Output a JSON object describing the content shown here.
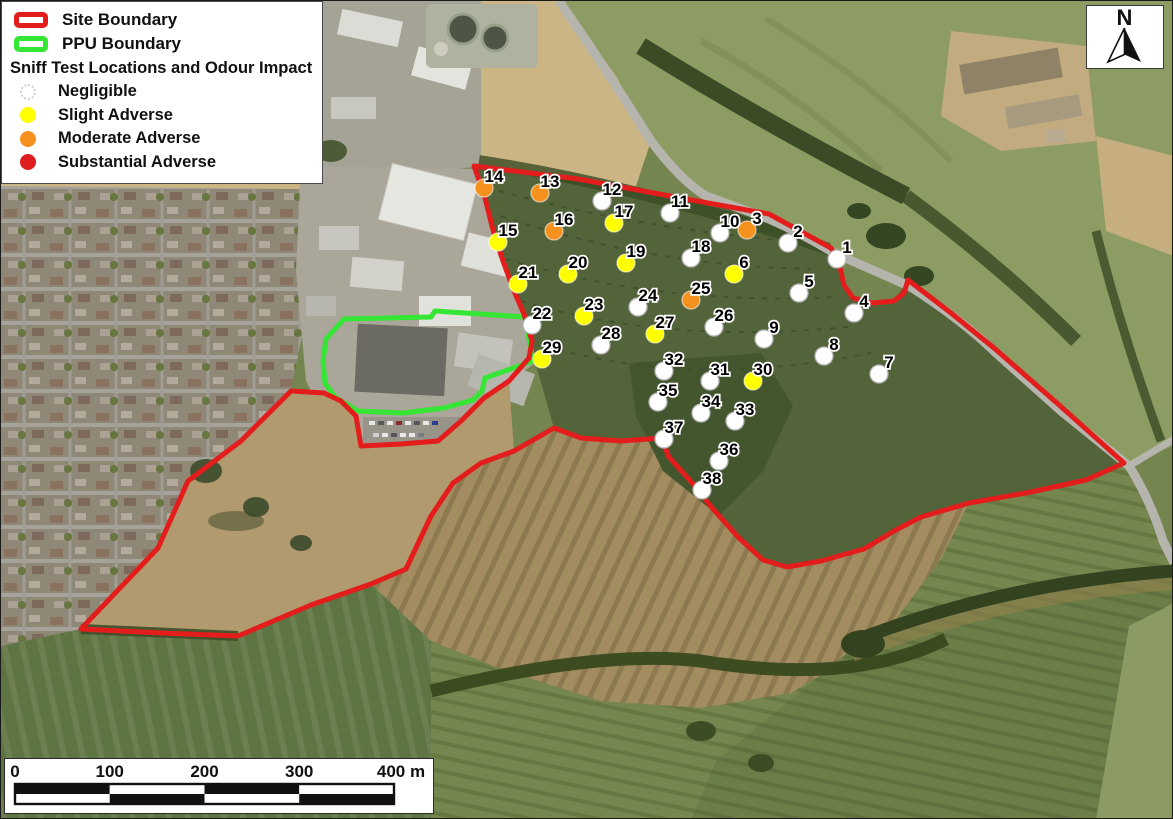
{
  "legend": {
    "site_boundary_label": "Site Boundary",
    "ppu_boundary_label": "PPU Boundary",
    "heading": "Sniff Test Locations and Odour Impact",
    "categories": [
      {
        "key": "negligible",
        "label": "Negligible"
      },
      {
        "key": "slight",
        "label": "Slight Adverse"
      },
      {
        "key": "moderate",
        "label": "Moderate Adverse"
      },
      {
        "key": "substantial",
        "label": "Substantial Adverse"
      }
    ]
  },
  "colors": {
    "site_boundary": "#e31c1c",
    "ppu_boundary": "#35e635",
    "negligible": "#ffffff",
    "slight": "#ffff00",
    "moderate": "#f5921e",
    "substantial": "#df1f1f",
    "marker_border": "#b5b5b5",
    "label_text": "#000000",
    "label_halo": "#ffffff"
  },
  "north_arrow": {
    "label": "N"
  },
  "scale_bar": {
    "tick_labels": [
      "0",
      "100",
      "200",
      "300"
    ],
    "end_label": "400 m"
  },
  "points": [
    {
      "id": "1",
      "x": 836,
      "y": 258,
      "impact": "negligible"
    },
    {
      "id": "2",
      "x": 787,
      "y": 242,
      "impact": "negligible"
    },
    {
      "id": "3",
      "x": 746,
      "y": 229,
      "impact": "moderate"
    },
    {
      "id": "4",
      "x": 853,
      "y": 312,
      "impact": "negligible"
    },
    {
      "id": "5",
      "x": 798,
      "y": 292,
      "impact": "negligible"
    },
    {
      "id": "6",
      "x": 733,
      "y": 273,
      "impact": "slight"
    },
    {
      "id": "7",
      "x": 878,
      "y": 373,
      "impact": "negligible"
    },
    {
      "id": "8",
      "x": 823,
      "y": 355,
      "impact": "negligible"
    },
    {
      "id": "9",
      "x": 763,
      "y": 338,
      "impact": "negligible"
    },
    {
      "id": "10",
      "x": 719,
      "y": 232,
      "impact": "negligible"
    },
    {
      "id": "11",
      "x": 669,
      "y": 212,
      "impact": "negligible"
    },
    {
      "id": "12",
      "x": 601,
      "y": 200,
      "impact": "negligible"
    },
    {
      "id": "13",
      "x": 539,
      "y": 192,
      "impact": "moderate"
    },
    {
      "id": "14",
      "x": 483,
      "y": 187,
      "impact": "moderate"
    },
    {
      "id": "15",
      "x": 497,
      "y": 241,
      "impact": "slight"
    },
    {
      "id": "16",
      "x": 553,
      "y": 230,
      "impact": "moderate"
    },
    {
      "id": "17",
      "x": 613,
      "y": 222,
      "impact": "slight"
    },
    {
      "id": "18",
      "x": 690,
      "y": 257,
      "impact": "negligible"
    },
    {
      "id": "19",
      "x": 625,
      "y": 262,
      "impact": "slight"
    },
    {
      "id": "20",
      "x": 567,
      "y": 273,
      "impact": "slight"
    },
    {
      "id": "21",
      "x": 517,
      "y": 283,
      "impact": "slight"
    },
    {
      "id": "22",
      "x": 531,
      "y": 324,
      "impact": "negligible"
    },
    {
      "id": "23",
      "x": 583,
      "y": 315,
      "impact": "slight"
    },
    {
      "id": "24",
      "x": 637,
      "y": 306,
      "impact": "negligible"
    },
    {
      "id": "25",
      "x": 690,
      "y": 299,
      "impact": "moderate"
    },
    {
      "id": "26",
      "x": 713,
      "y": 326,
      "impact": "negligible"
    },
    {
      "id": "27",
      "x": 654,
      "y": 333,
      "impact": "slight"
    },
    {
      "id": "28",
      "x": 600,
      "y": 344,
      "impact": "negligible"
    },
    {
      "id": "29",
      "x": 541,
      "y": 358,
      "impact": "slight"
    },
    {
      "id": "30",
      "x": 752,
      "y": 380,
      "impact": "slight"
    },
    {
      "id": "31",
      "x": 709,
      "y": 380,
      "impact": "negligible"
    },
    {
      "id": "32",
      "x": 663,
      "y": 370,
      "impact": "negligible"
    },
    {
      "id": "33",
      "x": 734,
      "y": 420,
      "impact": "negligible"
    },
    {
      "id": "34",
      "x": 700,
      "y": 412,
      "impact": "negligible"
    },
    {
      "id": "35",
      "x": 657,
      "y": 401,
      "impact": "negligible"
    },
    {
      "id": "36",
      "x": 718,
      "y": 460,
      "impact": "negligible"
    },
    {
      "id": "37",
      "x": 663,
      "y": 438,
      "impact": "negligible"
    },
    {
      "id": "38",
      "x": 701,
      "y": 489,
      "impact": "negligible"
    }
  ]
}
